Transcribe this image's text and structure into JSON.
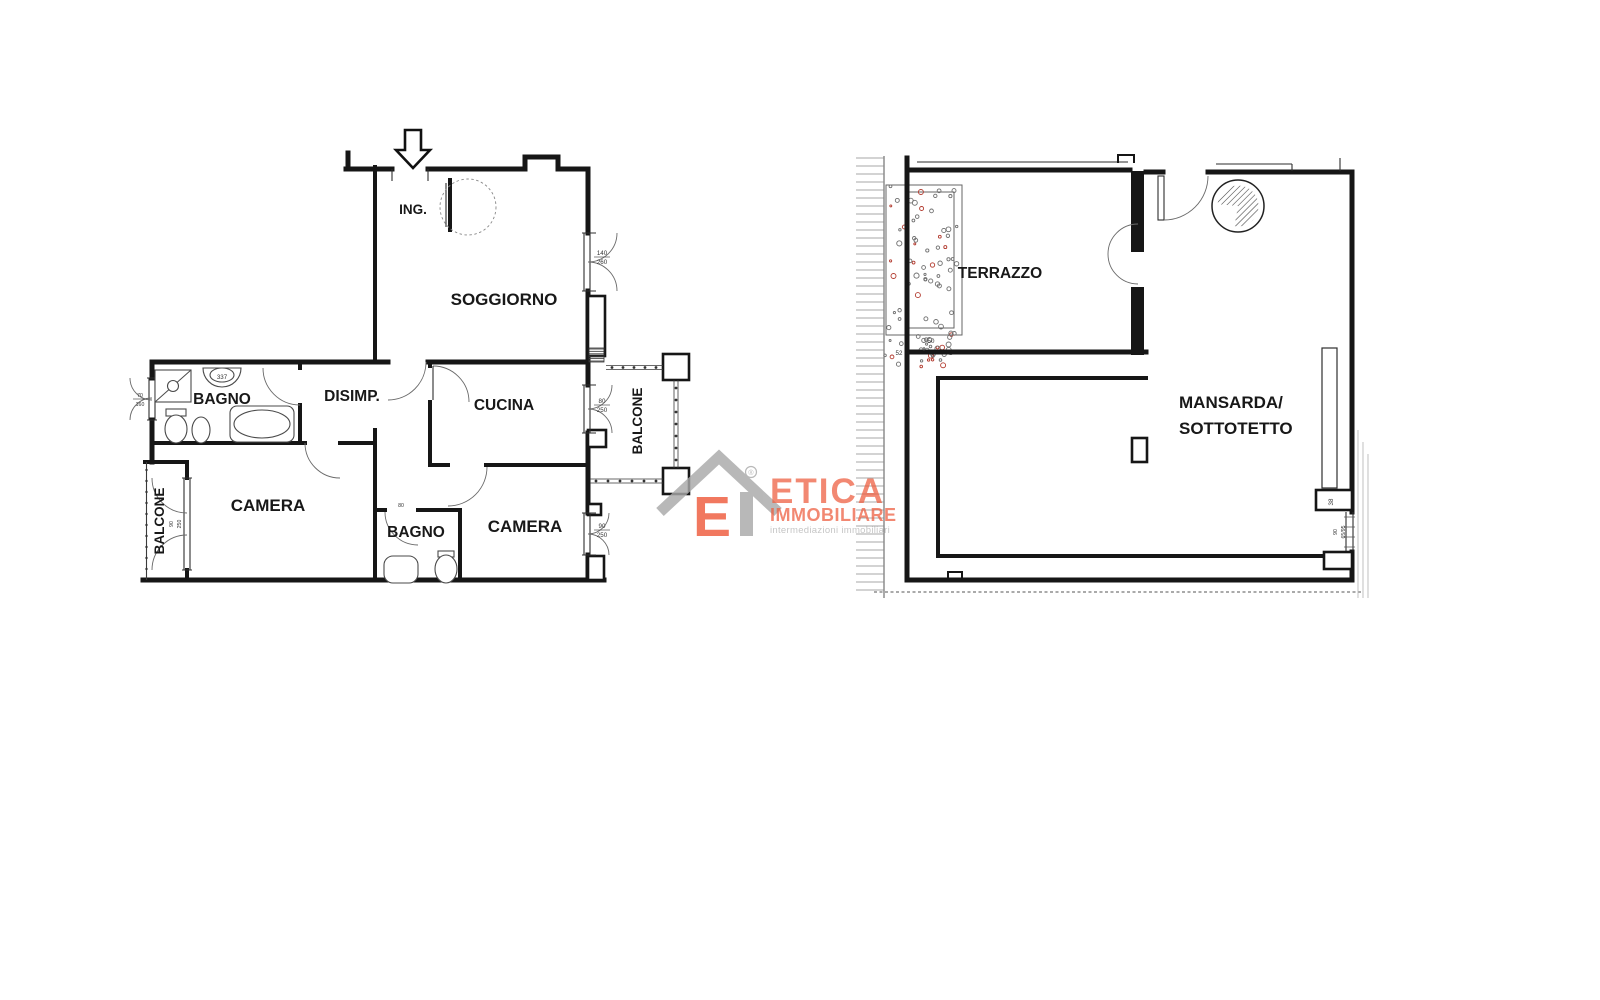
{
  "left_plan": {
    "rooms": {
      "ing": "ING.",
      "soggiorno": "SOGGIORNO",
      "bagno_top": "BAGNO",
      "disimp": "DISIMP.",
      "cucina": "CUCINA",
      "camera_left": "CAMERA",
      "bagno_bottom": "BAGNO",
      "camera_right": "CAMERA",
      "balcone_left": "BALCONE",
      "balcone_right": "BALCONE"
    },
    "measurements": {
      "sink_model": "337",
      "bagno_window_w": "70",
      "bagno_window_h": "160",
      "soggiorno_window_w": "140",
      "soggiorno_window_h": "260",
      "cucina_window_w": "80",
      "cucina_window_h": "250",
      "camera_right_window_w": "90",
      "camera_right_window_h": "250",
      "camera_left_window_w": "90",
      "camera_left_window_h": "250",
      "bagno_bottom_door_w": "80"
    }
  },
  "right_plan": {
    "rooms": {
      "terrazzo": "TERRAZZO",
      "mansarda_line1": "MANSARDA/",
      "mansarda_line2": "SOTTOTETTO"
    },
    "measurements": {
      "planter_depth": "50",
      "planter_gap": "8",
      "planter_width": "52",
      "niche_depth": "38",
      "window_w": "90",
      "window_size": "65/95"
    }
  },
  "watermark": {
    "brand": "ETICA",
    "brand_suffix": "IMMOBILIARE",
    "tagline": "intermediazioni immobiliari",
    "registered_mark": "®"
  },
  "colors": {
    "wall": "#161616",
    "brand_orange": "#ee5b3c",
    "brand_gray": "#a9a9a9",
    "tagline_gray": "#c6c6c6",
    "vegetation_green": "#6f6f6f",
    "vegetation_accent": "#b23a2e"
  }
}
